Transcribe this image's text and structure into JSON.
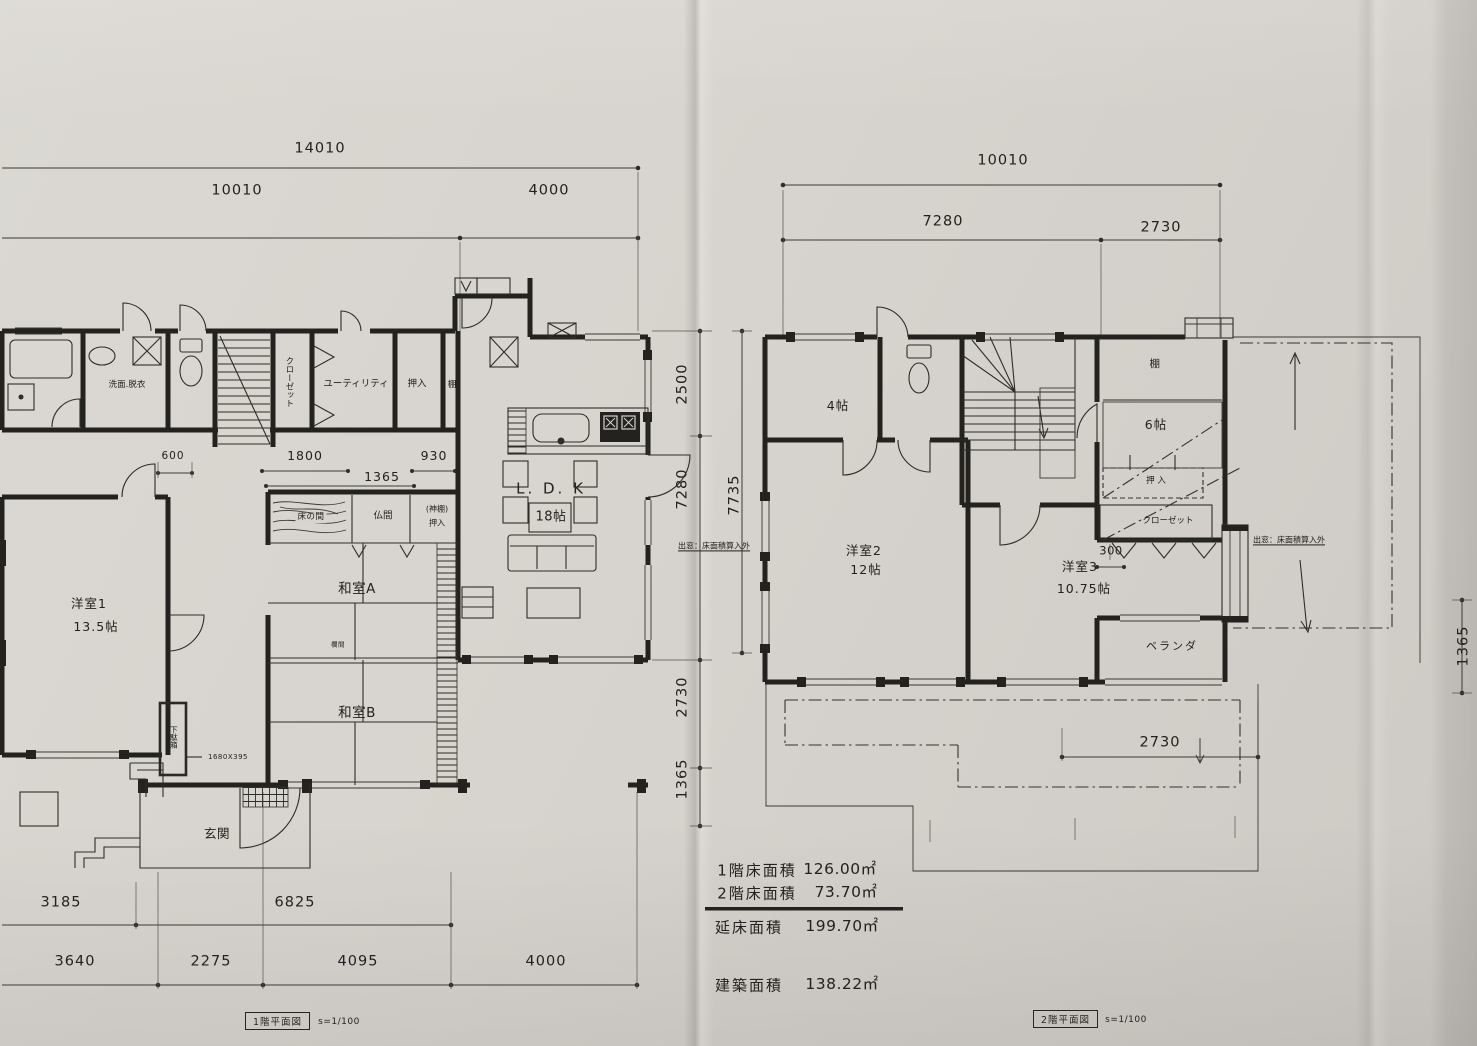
{
  "plan_1f": {
    "caption": "1階平面図",
    "scale": "s=1/100",
    "dims": {
      "top_overall": "14010",
      "top_left": "10010",
      "top_right": "4000",
      "inner_600": "600",
      "inner_1800": "1800",
      "inner_930": "930",
      "inner_1365": "1365",
      "right_2500": "2500",
      "right_7280": "7280",
      "right_overall": "7735",
      "right_2730": "2730",
      "right_1365": "1365",
      "bottom_inner_left": "3185",
      "bottom_inner_right": "6825",
      "bottom_outer": [
        "3640",
        "2275",
        "4095",
        "4000"
      ]
    },
    "rooms": {
      "washroom": "洗面.脱衣",
      "closet": "クローゼット",
      "utility": "ユーティリティ",
      "oshiire": "押入",
      "shelf": "棚",
      "ldk": "L. D. K",
      "ldk_size": "18帖",
      "western1": "洋室1",
      "western1_size": "13.5帖",
      "tokonoma": "床の間",
      "butsuma": "仏間",
      "kamidana_line1": "(神棚)",
      "kamidana_line2": "押入",
      "japanese_a": "和室A",
      "ranma": "欄間",
      "japanese_b": "和室B",
      "shoe_cabinet": "下駄箱",
      "shoe_cabinet_size": "1680X395",
      "entrance": "玄関"
    },
    "bay_window_note": "出窓：床面積算入外"
  },
  "plan_2f": {
    "caption": "2階平面図",
    "scale": "s=1/100",
    "dims": {
      "top_overall": "10010",
      "top_left": "7280",
      "top_right": "2730",
      "inner_300": "300",
      "bottom_2730": "2730",
      "right_1365": "1365"
    },
    "rooms": {
      "room4": "4帖",
      "shelf": "棚",
      "room6": "6帖",
      "oshiire": "押 入",
      "closet": "クローゼット",
      "western2": "洋室2",
      "western2_size": "12帖",
      "western3": "洋室3",
      "western3_size": "10.75帖",
      "veranda": "ベランダ"
    },
    "bay_window_note": "出窓：床面積算入外"
  },
  "area_table": {
    "rows": [
      {
        "label": "1階床面積",
        "value": "126.00㎡"
      },
      {
        "label": "2階床面積",
        "value": "73.70㎡"
      },
      {
        "label": "延床面積",
        "value": "199.70㎡"
      },
      {
        "label": "建築面積",
        "value": "138.22㎡"
      }
    ]
  },
  "colors": {
    "paper": "#d7d3ce",
    "ink": "#23221e"
  }
}
